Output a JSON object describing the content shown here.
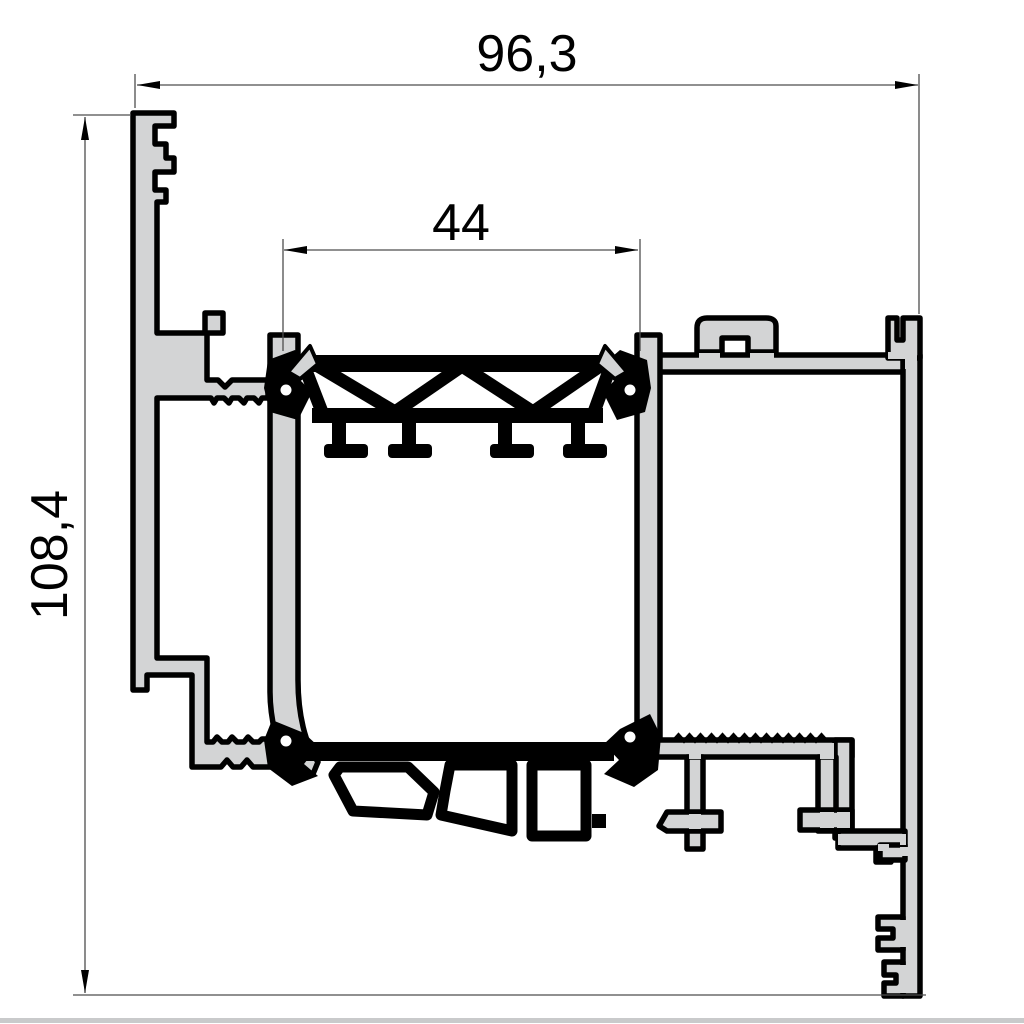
{
  "drawing": {
    "type": "technical-cross-section",
    "subject": "Aluminium window frame profile system section with thermal breaks and glazing gaskets"
  },
  "dimensions": {
    "overall_width": {
      "label": "96,3",
      "orientation": "horizontal",
      "position": "top"
    },
    "glazing_width": {
      "label": "44",
      "orientation": "horizontal",
      "position": "middle"
    },
    "overall_height": {
      "label": "108,4",
      "orientation": "vertical",
      "position": "left"
    }
  },
  "colors": {
    "background": "#ffffff",
    "profile_fill": "#d3d4d5",
    "outline": "#000000",
    "thermal_break_fill": "#000000",
    "dimension_line": "#4d4d4d",
    "dimension_text": "#000000",
    "bottom_border": "#c9cacb"
  }
}
